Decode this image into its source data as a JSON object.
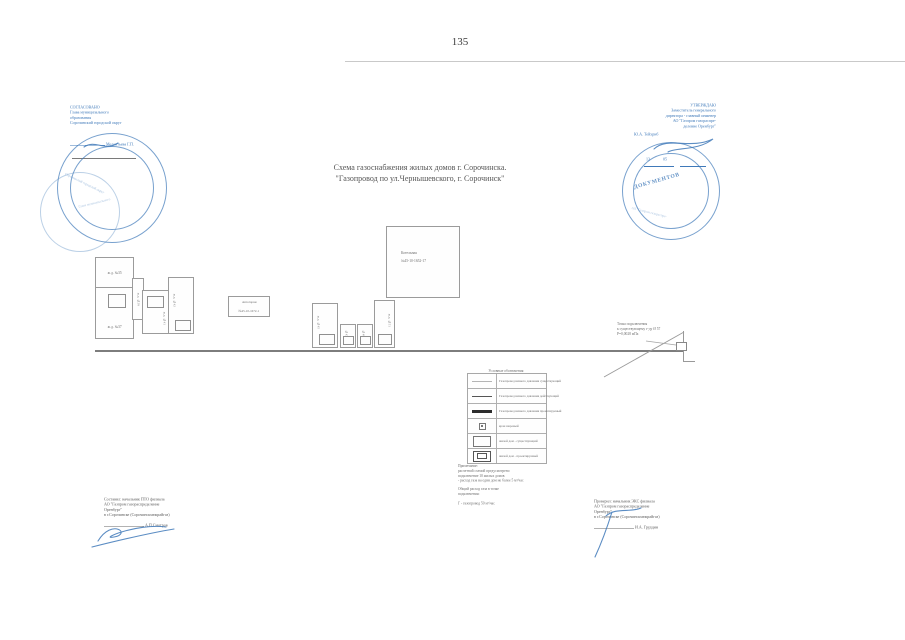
{
  "page": {
    "number": "135"
  },
  "title": {
    "line1": "Схема газоснабжения жилых домов г. Сорочинска.",
    "line2": "\"Газопровод по ул.Чернышевского, г. Сорочинск\""
  },
  "stamp_left": {
    "title": "СОГЛАСОВАНО",
    "line2": "Глава муниципального",
    "line3": "образования",
    "line4": "Сорочинский городской округ",
    "name": "Мелентьева Г.П."
  },
  "stamp_right": {
    "title": "УТВЕРЖДАЮ",
    "line2": "Заместитель генерального",
    "line3": "директора - главный инженер",
    "line4": "АО \"Газпром газораспре-",
    "line5": "деление Оренбург\"",
    "name": "Ю.А. Тейхриб",
    "date": "13             05",
    "seal": "ДОКУМЕНТОВ"
  },
  "diagram": {
    "kotelnaya_line1": "Котельная",
    "kotelnaya_line2": "№45-10-1652-17",
    "garage_line1": "Автогараж",
    "garage_line2": "№45-10-1672-1",
    "left_a": "ж.д. №35",
    "left_b": "ж.д. №37",
    "left_c": "ж.д. №39",
    "left_d": "ж.д. №41",
    "left_e": "ж.д. №43",
    "mid_a": "ж.д. №45",
    "mid_b": "№47",
    "mid_c": "№49",
    "mid_d": "ж.д. №51",
    "connection_line1": "Точка подключения",
    "connection_line2": "к существующему г-ду Ø 57",
    "connection_line3": "Р=0,0028 мПа"
  },
  "legend": {
    "title": "Условные обозначения",
    "rows": [
      {
        "label": "Газопровод низкого давления существующий"
      },
      {
        "label": "Газопровод низкого давления действующий"
      },
      {
        "label": "Газопровод низкого давления проектируемый"
      },
      {
        "label": "кран шаровый"
      },
      {
        "label": "жилой дом - существующий"
      },
      {
        "label": "жилой дом - проектируемый"
      }
    ]
  },
  "notes": {
    "l1": "Примечание:",
    "l2": "расчетной схемой предусмотрено",
    "l3": "подключение 10 жилых домов",
    "l4": "- расход газа на один дом не более 5 м³/час",
    "l5": "Общий расход газа в точке",
    "l6": "подключения:",
    "l7": "Г - газопровод         50 м³/час"
  },
  "sign_left": {
    "l1": "Составил: начальник ПТО филиала",
    "l2": "АО \"Газпром газораспределение",
    "l3": "Оренбург\"",
    "l4": "в г.Сорочинске (Сорочинскмежрайгаз)",
    "name": "А.П.Смотров"
  },
  "sign_right": {
    "l1": "Проверил: начальник  ЭКС филиала",
    "l2": "АО \"Газпром газораспределение",
    "l3": "Оренбург\"",
    "l4": "в г.Сорочинске (Сорочинскмежрайгаз)",
    "name": "И.А. Грудцин"
  },
  "colors": {
    "stamp_blue": "#3f79b9",
    "diagram_gray": "#9b9b9b",
    "main_line_gray": "#7d7d7d"
  }
}
